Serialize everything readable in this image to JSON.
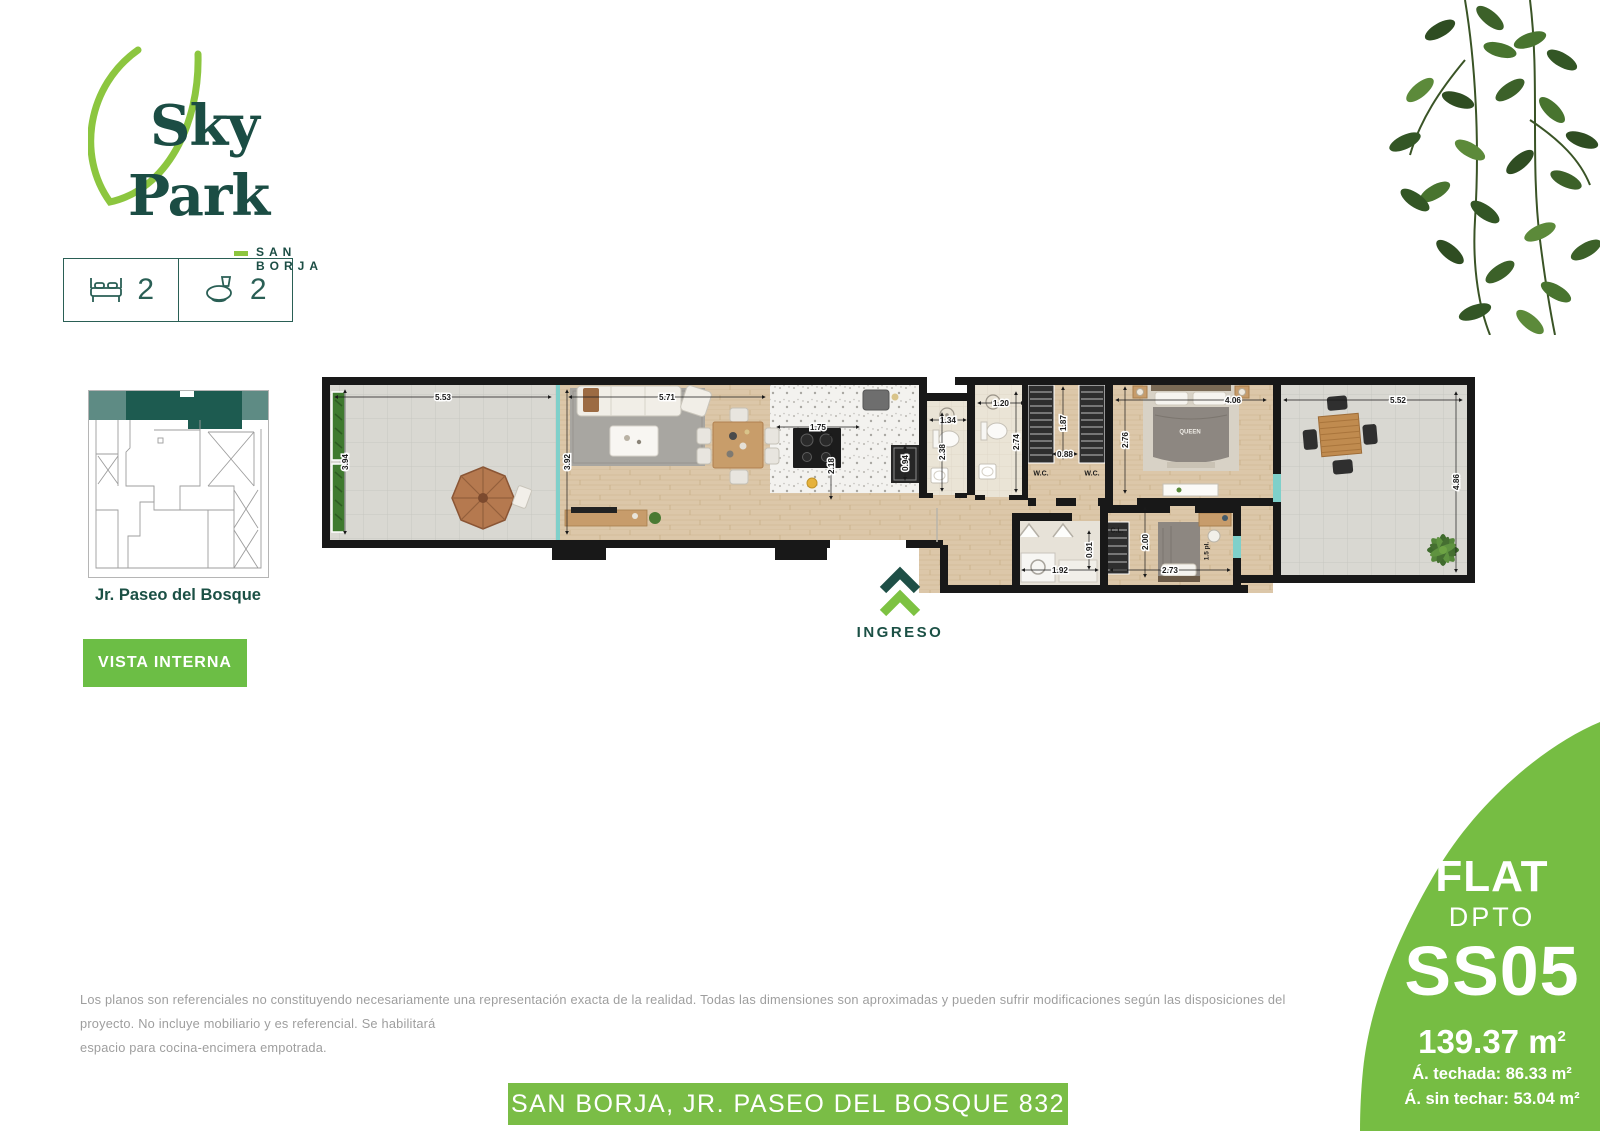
{
  "logo": {
    "line1": "Sky",
    "line2": "Park",
    "subtitle": "SAN BORJA"
  },
  "features": {
    "bedrooms": "2",
    "bathrooms": "2"
  },
  "location_map": {
    "street": "Jr. Paseo del Bosque"
  },
  "vista_button_label": "VISTA INTERNA",
  "entrance_label": "INGRESO",
  "colors": {
    "brand_teal": "#1b4d44",
    "brand_green": "#76bd43",
    "leaf_green": "#8cc63f",
    "button_green": "#6cbe45",
    "glass_cyan": "#7fd0ca"
  },
  "plan": {
    "dims": [
      {
        "t": "5.53",
        "x": 128,
        "y": 27,
        "r": 0,
        "len": 216
      },
      {
        "t": "3.94",
        "x": 30,
        "y": 92,
        "r": 90,
        "len": 144
      },
      {
        "t": "5.71",
        "x": 352,
        "y": 27,
        "r": 0,
        "len": 196
      },
      {
        "t": "3.92",
        "x": 252,
        "y": 92,
        "r": 90,
        "len": 144
      },
      {
        "t": "1.75",
        "x": 503,
        "y": 57,
        "r": 0,
        "len": 82
      },
      {
        "t": "2.18",
        "x": 516,
        "y": 96,
        "r": 90,
        "len": 66
      },
      {
        "t": "0.94",
        "x": 590,
        "y": 93,
        "r": 90,
        "len": 34
      },
      {
        "t": "1.34",
        "x": 633,
        "y": 50,
        "r": 0,
        "len": 36
      },
      {
        "t": "2.38",
        "x": 627,
        "y": 82,
        "r": 90,
        "len": 78
      },
      {
        "t": "1.20",
        "x": 686,
        "y": 33,
        "r": 0,
        "len": 46
      },
      {
        "t": "2.74",
        "x": 701,
        "y": 72,
        "r": 90,
        "len": 100
      },
      {
        "t": "1.87",
        "x": 748,
        "y": 53,
        "r": 90,
        "len": 72
      },
      {
        "t": "0.88",
        "x": 750,
        "y": 84,
        "r": 0,
        "len": 24
      },
      {
        "t": "2.76",
        "x": 810,
        "y": 70,
        "r": 90,
        "len": 106
      },
      {
        "t": "4.06",
        "x": 918,
        "y": 30,
        "r": 0,
        "len": 150,
        "cx": 876
      },
      {
        "t": "5.52",
        "x": 1083,
        "y": 30,
        "r": 0,
        "len": 178,
        "cx": 1058
      },
      {
        "t": "4.86",
        "x": 1141,
        "y": 112,
        "r": 90,
        "len": 180
      },
      {
        "t": "2.00",
        "x": 830,
        "y": 172,
        "r": 90,
        "len": 70
      },
      {
        "t": "1.92",
        "x": 745,
        "y": 200,
        "r": 0,
        "len": 76
      },
      {
        "t": "0.91",
        "x": 774,
        "y": 180,
        "r": 90,
        "len": 38
      },
      {
        "t": "2.73",
        "x": 855,
        "y": 200,
        "r": 0,
        "len": 120
      }
    ],
    "room_labels": [
      {
        "t": "W.C.",
        "x": 726,
        "y": 103,
        "s": 7,
        "r": 0,
        "c": "#1a1a1a"
      },
      {
        "t": "W.C.",
        "x": 777,
        "y": 103,
        "s": 7,
        "r": 0,
        "c": "#1a1a1a"
      },
      {
        "t": "C.L.",
        "x": 802,
        "y": 160,
        "s": 7,
        "r": 0,
        "c": "#1a1a1a"
      },
      {
        "t": "QUEEN",
        "x": 875,
        "y": 61,
        "s": 6,
        "r": 0,
        "c": "#efece6"
      },
      {
        "t": "1.5 pl.",
        "x": 891,
        "y": 181,
        "s": 6.5,
        "r": 90,
        "c": "#1a1a1a"
      }
    ]
  },
  "badge": {
    "type": "FLAT",
    "subtype": "DPTO",
    "unit": "SS05",
    "area_value": "139.37 m",
    "area_sup": "2",
    "area_roofed": "Á. techada: 86.33 m²",
    "area_open": "Á. sin techar: 53.04 m²"
  },
  "disclaimer": {
    "lines": [
      "Los planos son referenciales no constituyendo necesariamente una representación exacta de la realidad. Todas las dimensiones son aproximadas y pueden sufrir modificaciones según las disposiciones del proyecto. No incluye mobiliario y es referencial. Se habilitará",
      "espacio para cocina-encimera empotrada."
    ]
  },
  "footer_banner": "SAN BORJA, JR. PASEO DEL BOSQUE 832"
}
